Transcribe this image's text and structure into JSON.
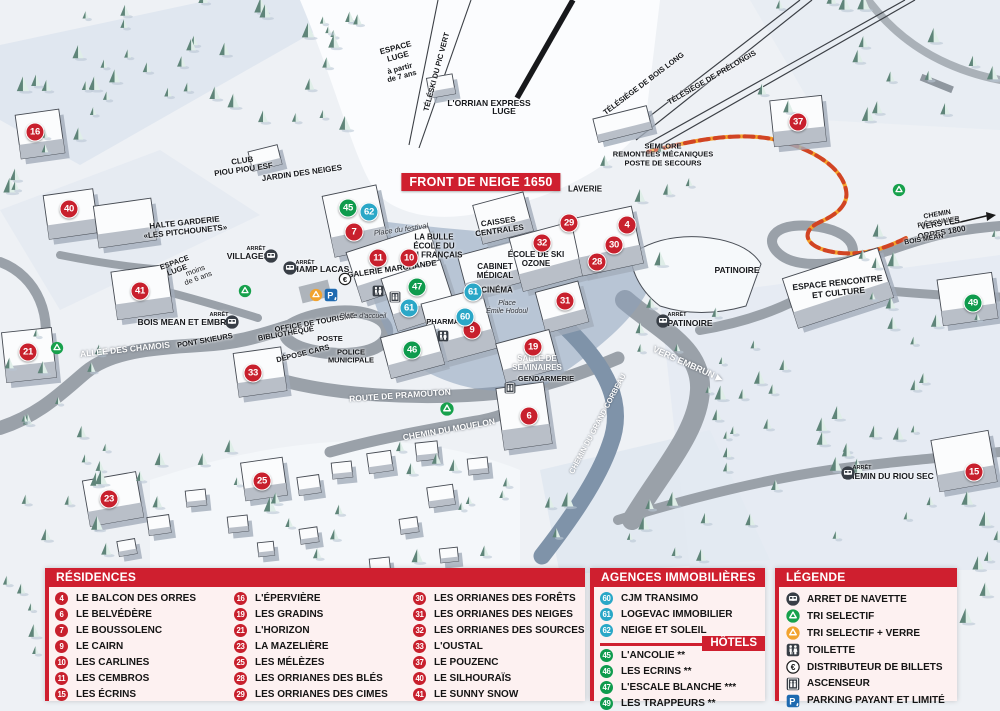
{
  "map": {
    "banner": "FRONT DE NEIGE 1650",
    "marker_colors": {
      "residence": "#c8202d",
      "hotel": "#0f9b4d",
      "agency": "#2aa7c7"
    },
    "markers": [
      {
        "n": "16",
        "type": "res",
        "x": 35,
        "y": 132
      },
      {
        "n": "40",
        "type": "res",
        "x": 69,
        "y": 209
      },
      {
        "n": "41",
        "type": "res",
        "x": 140,
        "y": 291
      },
      {
        "n": "21",
        "type": "res",
        "x": 28,
        "y": 352
      },
      {
        "n": "33",
        "type": "res",
        "x": 253,
        "y": 373
      },
      {
        "n": "23",
        "type": "res",
        "x": 109,
        "y": 499
      },
      {
        "n": "25",
        "type": "res",
        "x": 262,
        "y": 481
      },
      {
        "n": "7",
        "type": "res",
        "x": 354,
        "y": 232
      },
      {
        "n": "11",
        "type": "res",
        "x": 378,
        "y": 258
      },
      {
        "n": "10",
        "type": "res",
        "x": 409,
        "y": 258
      },
      {
        "n": "9",
        "type": "res",
        "x": 472,
        "y": 330
      },
      {
        "n": "32",
        "type": "res",
        "x": 542,
        "y": 243
      },
      {
        "n": "29",
        "type": "res",
        "x": 569,
        "y": 223
      },
      {
        "n": "4",
        "type": "res",
        "x": 627,
        "y": 225
      },
      {
        "n": "30",
        "type": "res",
        "x": 614,
        "y": 245
      },
      {
        "n": "28",
        "type": "res",
        "x": 597,
        "y": 262
      },
      {
        "n": "31",
        "type": "res",
        "x": 565,
        "y": 301
      },
      {
        "n": "19",
        "type": "res",
        "x": 533,
        "y": 347
      },
      {
        "n": "6",
        "type": "res",
        "x": 529,
        "y": 416
      },
      {
        "n": "15",
        "type": "res",
        "x": 974,
        "y": 472
      },
      {
        "n": "37",
        "type": "res",
        "x": 798,
        "y": 122
      },
      {
        "n": "45",
        "type": "hot",
        "x": 348,
        "y": 208
      },
      {
        "n": "47",
        "type": "hot",
        "x": 417,
        "y": 287
      },
      {
        "n": "46",
        "type": "hot",
        "x": 412,
        "y": 350
      },
      {
        "n": "49",
        "type": "hot",
        "x": 973,
        "y": 303
      },
      {
        "n": "62",
        "type": "ag",
        "x": 369,
        "y": 212
      },
      {
        "n": "61",
        "type": "ag",
        "x": 409,
        "y": 308
      },
      {
        "n": "61",
        "type": "ag",
        "x": 473,
        "y": 292
      },
      {
        "n": "60",
        "type": "ag",
        "x": 465,
        "y": 317
      }
    ],
    "labels": [
      {
        "t": "ESPACE\nLUGE",
        "x": 397,
        "y": 53,
        "r": -15,
        "fs": 8
      },
      {
        "t": "à partir\nde 7 ans",
        "x": 401,
        "y": 73,
        "r": -15,
        "fs": 7.5
      },
      {
        "t": "TÉLÉSKI DU PIC VERT",
        "x": 437,
        "y": 72,
        "r": -75,
        "fs": 7.5
      },
      {
        "t": "L'ORRIAN EXPRESS",
        "x": 489,
        "y": 104,
        "fs": 8.5
      },
      {
        "t": "LUGE",
        "x": 504,
        "y": 112,
        "fs": 8.5
      },
      {
        "t": "TÉLÉSIÈGE DE BOIS LONG",
        "x": 644,
        "y": 84,
        "r": -37,
        "fs": 7.5
      },
      {
        "t": "TÉLÉSIÈGE DE PRÉLONGIS",
        "x": 712,
        "y": 78,
        "r": -30,
        "fs": 7.5
      },
      {
        "t": "SEMLORE\nREMONTÉES MÉCANIQUES\nPOSTE DE SECOURS",
        "x": 663,
        "y": 155,
        "fs": 7.5
      },
      {
        "t": "LAVERIE",
        "x": 585,
        "y": 190,
        "fs": 8
      },
      {
        "t": "CAISSES\nCENTRALES",
        "x": 499,
        "y": 227,
        "r": -8,
        "fs": 8
      },
      {
        "t": "LA BULLE\nÉCOLE DU\nSKI FRANÇAIS",
        "x": 434,
        "y": 247,
        "fs": 8
      },
      {
        "t": "Place du festival",
        "x": 401,
        "y": 230,
        "r": -8,
        "fs": 7.5,
        "i": 1,
        "w": 400,
        "c": "#2d3138"
      },
      {
        "t": "ÉCOLE DE SKI\nOZONE",
        "x": 536,
        "y": 260,
        "fs": 8
      },
      {
        "t": "CABINET\nMÉDICAL",
        "x": 495,
        "y": 272,
        "fs": 8
      },
      {
        "t": "CINÉMA",
        "x": 497,
        "y": 291,
        "fs": 8
      },
      {
        "t": "Place\nÉmile Hodoul",
        "x": 507,
        "y": 308,
        "fs": 7,
        "i": 1,
        "w": 400,
        "c": "#2d3138"
      },
      {
        "t": "GALERIE MARCHANDE",
        "x": 392,
        "y": 270,
        "r": -8,
        "fs": 8
      },
      {
        "t": "PHARMACIE",
        "x": 449,
        "y": 322,
        "fs": 7.5
      },
      {
        "t": "CLUB\nPIOU PIOU ESF",
        "x": 243,
        "y": 166,
        "r": -8,
        "fs": 8
      },
      {
        "t": "JARDIN DES NEIGES",
        "x": 302,
        "y": 174,
        "r": -8,
        "fs": 8
      },
      {
        "t": "HALTE GARDERIE\n«LES PITCHOUNETS»",
        "x": 185,
        "y": 228,
        "r": -6,
        "fs": 8
      },
      {
        "t": "ESPACE\nLUGE",
        "x": 176,
        "y": 267,
        "r": -20,
        "fs": 7.5
      },
      {
        "t": "moins\nde 6 ans",
        "x": 197,
        "y": 275,
        "r": -20,
        "fs": 7.5,
        "w": 400
      },
      {
        "t": "ARRÊT",
        "x": 256,
        "y": 249,
        "fs": 5.5
      },
      {
        "t": "VILLAGES",
        "x": 248,
        "y": 257,
        "fs": 8.5
      },
      {
        "t": "ARRÊT",
        "x": 305,
        "y": 263,
        "fs": 5.5
      },
      {
        "t": "CHAMP LACAS",
        "x": 318,
        "y": 270,
        "fs": 8.5
      },
      {
        "t": "ARRÊT",
        "x": 219,
        "y": 315,
        "fs": 5.5
      },
      {
        "t": "BOIS MEAN ET EMBRUN",
        "x": 188,
        "y": 323,
        "fs": 8.5
      },
      {
        "t": "ALLÉE DES CHAMOIS",
        "x": 125,
        "y": 350,
        "r": -6,
        "fs": 8.5,
        "c": "#fff"
      },
      {
        "t": "PONT SKIEURS",
        "x": 205,
        "y": 341,
        "r": -10,
        "fs": 7.5
      },
      {
        "t": "BIBLIOTHÈQUE",
        "x": 286,
        "y": 334,
        "r": -10,
        "fs": 7.5
      },
      {
        "t": "OFFICE DE TOURISME",
        "x": 315,
        "y": 323,
        "r": -10,
        "fs": 7.5
      },
      {
        "t": "POSTE",
        "x": 330,
        "y": 339,
        "fs": 7.5
      },
      {
        "t": "DÉPOSE CARS",
        "x": 303,
        "y": 354,
        "r": -14,
        "fs": 7.5
      },
      {
        "t": "POLICE\nMUNICIPALE",
        "x": 351,
        "y": 357,
        "fs": 7.5
      },
      {
        "t": "Place d'accueil",
        "x": 363,
        "y": 317,
        "fs": 7,
        "i": 1,
        "w": 400,
        "c": "#2d3138"
      },
      {
        "t": "ROUTE DE PRAMOUTON",
        "x": 400,
        "y": 396,
        "r": -4,
        "fs": 8.5,
        "c": "#fff"
      },
      {
        "t": "CHEMIN DU MOUFLON",
        "x": 449,
        "y": 430,
        "r": -10,
        "fs": 8.5,
        "c": "#fff"
      },
      {
        "t": "CHEMIN DU GRAND CORBEAU",
        "x": 598,
        "y": 424,
        "r": -62,
        "fs": 7.5,
        "c": "#fff"
      },
      {
        "t": "SALLE DE\nSÉMINAIRES",
        "x": 537,
        "y": 364,
        "fs": 8,
        "c": "#fff"
      },
      {
        "t": "GENDARMERIE",
        "x": 546,
        "y": 379,
        "fs": 7.5
      },
      {
        "t": "VERS EMBRUN ▶",
        "x": 688,
        "y": 364,
        "r": 24,
        "fs": 9,
        "c": "#fff"
      },
      {
        "t": "PATINOIRE",
        "x": 737,
        "y": 271,
        "fs": 8.5
      },
      {
        "t": "ARRÊT",
        "x": 677,
        "y": 315,
        "fs": 5.5
      },
      {
        "t": "PATINOIRE",
        "x": 690,
        "y": 324,
        "fs": 8.5
      },
      {
        "t": "ESPACE RENCONTRE\nET CULTURE",
        "x": 838,
        "y": 288,
        "r": -6,
        "fs": 8.5
      },
      {
        "t": "CHEMIN PIÉTONNIER",
        "x": 938,
        "y": 219,
        "r": -10,
        "fs": 7
      },
      {
        "t": "VERS LES ORRES 1800",
        "x": 941,
        "y": 229,
        "r": -10,
        "fs": 8
      },
      {
        "t": "BOIS MÉAN",
        "x": 924,
        "y": 240,
        "r": -10,
        "fs": 7
      },
      {
        "t": "ARRÊT",
        "x": 862,
        "y": 468,
        "fs": 5.5
      },
      {
        "t": "CHEMIN DU RIOU SEC",
        "x": 888,
        "y": 477,
        "fs": 8.5
      }
    ],
    "icons": [
      {
        "name": "bus",
        "x": 271,
        "y": 256,
        "s": 14
      },
      {
        "name": "bus",
        "x": 290,
        "y": 268,
        "s": 14
      },
      {
        "name": "bus",
        "x": 232,
        "y": 322,
        "s": 14
      },
      {
        "name": "bus",
        "x": 663,
        "y": 321,
        "s": 14
      },
      {
        "name": "bus",
        "x": 848,
        "y": 473,
        "s": 14
      },
      {
        "name": "recycle-green",
        "x": 57,
        "y": 348,
        "s": 13
      },
      {
        "name": "recycle-green",
        "x": 245,
        "y": 291,
        "s": 13
      },
      {
        "name": "recycle-green",
        "x": 447,
        "y": 409,
        "s": 14
      },
      {
        "name": "recycle-green",
        "x": 899,
        "y": 190,
        "s": 13
      },
      {
        "name": "recycle-orange",
        "x": 316,
        "y": 295,
        "s": 13
      },
      {
        "name": "parking",
        "x": 331,
        "y": 295,
        "s": 14
      },
      {
        "name": "euro",
        "x": 345,
        "y": 279,
        "s": 13
      },
      {
        "name": "toilet",
        "x": 378,
        "y": 291,
        "s": 12
      },
      {
        "name": "toilet",
        "x": 443,
        "y": 336,
        "s": 12
      },
      {
        "name": "elevator",
        "x": 395,
        "y": 297,
        "s": 12
      },
      {
        "name": "elevator",
        "x": 510,
        "y": 388,
        "s": 12
      }
    ]
  },
  "legend": {
    "residences_header": "RÉSIDENCES",
    "residences": [
      {
        "n": "4",
        "label": "LE BALCON DES ORRES"
      },
      {
        "n": "6",
        "label": "LE BELVÉDÈRE"
      },
      {
        "n": "7",
        "label": "LE BOUSSOLENC"
      },
      {
        "n": "9",
        "label": "LE CAIRN"
      },
      {
        "n": "10",
        "label": "LES CARLINES"
      },
      {
        "n": "11",
        "label": "LES CEMBROS"
      },
      {
        "n": "15",
        "label": "LES ÉCRINS"
      },
      {
        "n": "16",
        "label": "L'ÉPERVIÈRE"
      },
      {
        "n": "19",
        "label": "LES GRADINS"
      },
      {
        "n": "21",
        "label": "L'HORIZON"
      },
      {
        "n": "23",
        "label": "LA MAZELIÈRE"
      },
      {
        "n": "25",
        "label": "LES MÉLÈZES"
      },
      {
        "n": "28",
        "label": "LES ORRIANES DES BLÉS"
      },
      {
        "n": "29",
        "label": "LES ORRIANES DES CIMES"
      },
      {
        "n": "30",
        "label": "LES ORRIANES DES FORÊTS"
      },
      {
        "n": "31",
        "label": "LES ORRIANES DES NEIGES"
      },
      {
        "n": "32",
        "label": "LES ORRIANES DES SOURCES"
      },
      {
        "n": "33",
        "label": "L'OUSTAL"
      },
      {
        "n": "37",
        "label": "LE POUZENC"
      },
      {
        "n": "40",
        "label": "LE SILHOURAÏS"
      },
      {
        "n": "41",
        "label": "LE SUNNY SNOW"
      }
    ],
    "agences_header": "AGENCES IMMOBILIÈRES",
    "agences": [
      {
        "n": "60",
        "label": "CJM TRANSIMO"
      },
      {
        "n": "61",
        "label": "LOGEVAC IMMOBILIER"
      },
      {
        "n": "62",
        "label": "NEIGE ET SOLEIL"
      }
    ],
    "hotels_header": "HÔTELS",
    "hotels": [
      {
        "n": "45",
        "label": "L'ANCOLIE **"
      },
      {
        "n": "46",
        "label": "LES ECRINS **"
      },
      {
        "n": "47",
        "label": "L'ESCALE BLANCHE ***"
      },
      {
        "n": "49",
        "label": "LES TRAPPEURS **"
      }
    ],
    "legende_header": "LÉGENDE",
    "legende": [
      {
        "icon": "bus",
        "label": "ARRET DE NAVETTE"
      },
      {
        "icon": "recycle-green",
        "label": "TRI SELECTIF"
      },
      {
        "icon": "recycle-orange",
        "label": "TRI SELECTIF + VERRE"
      },
      {
        "icon": "toilet",
        "label": "TOILETTE"
      },
      {
        "icon": "euro",
        "label": "DISTRIBUTEUR DE BILLETS"
      },
      {
        "icon": "elevator",
        "label": "ASCENSEUR"
      },
      {
        "icon": "parking",
        "label": "PARKING PAYANT ET LIMITÉ"
      }
    ]
  }
}
